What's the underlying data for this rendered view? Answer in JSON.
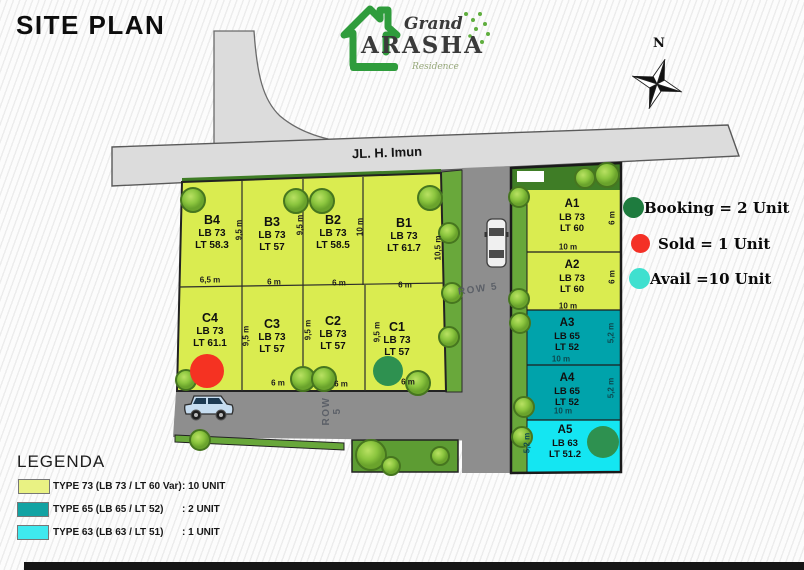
{
  "title": "SITE PLAN",
  "logo": {
    "grand": "Grand",
    "arasha": "ARASHA",
    "residence": "Residence"
  },
  "compass": {
    "north": "N"
  },
  "roads": {
    "main_label": "JL. H. Imun",
    "row5_vertical": "ROW 5",
    "row5_bottom": "ROW 5"
  },
  "plots": [
    {
      "id": "B4",
      "lb": "LB 73",
      "lt": "LT 58.3",
      "width_label": "6,5 m",
      "side_label": "9,5 m"
    },
    {
      "id": "B3",
      "lb": "LB 73",
      "lt": "LT 57",
      "width_label": "6 m",
      "side_label": "9,5 m"
    },
    {
      "id": "B2",
      "lb": "LB 73",
      "lt": "LT 58.5",
      "width_label": "6 m",
      "side_label": "10 m"
    },
    {
      "id": "B1",
      "lb": "LB 73",
      "lt": "LT 61.7",
      "width_label": "6 m",
      "side_label": "10,5 m"
    },
    {
      "id": "C4",
      "lb": "LB 73",
      "lt": "LT 61.1",
      "width_label": "",
      "side_label": "9,5 m"
    },
    {
      "id": "C3",
      "lb": "LB 73",
      "lt": "LT 57",
      "width_label": "6 m",
      "side_label": "9,5 m"
    },
    {
      "id": "C2",
      "lb": "LB 73",
      "lt": "LT 57",
      "width_label": "6 m",
      "side_label": "9,5 m"
    },
    {
      "id": "C1",
      "lb": "LB 73",
      "lt": "LT 57",
      "width_label": "6 m",
      "side_label": ""
    },
    {
      "id": "A1",
      "lb": "LB 73",
      "lt": "LT 60",
      "width_label": "10 m",
      "side_label": "6 m"
    },
    {
      "id": "A2",
      "lb": "LB 73",
      "lt": "LT 60",
      "width_label": "10 m",
      "side_label": "6 m"
    },
    {
      "id": "A3",
      "lb": "LB 65",
      "lt": "LT 52",
      "width_label": "10 m",
      "side_label": "5,2 m"
    },
    {
      "id": "A4",
      "lb": "LB 65",
      "lt": "LT 52",
      "width_label": "10 m",
      "side_label": "5,2 m"
    },
    {
      "id": "A5",
      "lb": "LB 63",
      "lt": "LT 51.2",
      "width_label": "",
      "side_label": "5,2 m"
    }
  ],
  "status_legend": {
    "booking": {
      "label": "Booking = 2 Unit",
      "color": "#1e7b3e"
    },
    "sold": {
      "label": "Sold = 1 Unit",
      "color": "#f43026"
    },
    "avail": {
      "label": "Avail =10 Unit",
      "color": "#3fe0cf"
    }
  },
  "legenda": {
    "title": "LEGENDA",
    "rows": [
      {
        "label": "TYPE 73  (LB 73 / LT 60 Var)",
        "count": ": 10 UNIT",
        "color": "#e9f283"
      },
      {
        "label": "TYPE 65  (LB 65 / LT 52)",
        "count": ": 2 UNIT",
        "color": "#12a3a3"
      },
      {
        "label": "TYPE 63  (LB 63 / LT 51)",
        "count": ": 1 UNIT",
        "color": "#3fe9ef"
      }
    ]
  },
  "map_colors": {
    "type73_fill": "#daec50",
    "type65_fill": "#00a3ab",
    "type63_fill": "#14e6f2",
    "sold_marker": "#f53222",
    "booking_marker": "#2e9150",
    "road_main": "#dcdcdc",
    "road_inner": "#8e8e8e",
    "green_strip": "#68a73a"
  }
}
